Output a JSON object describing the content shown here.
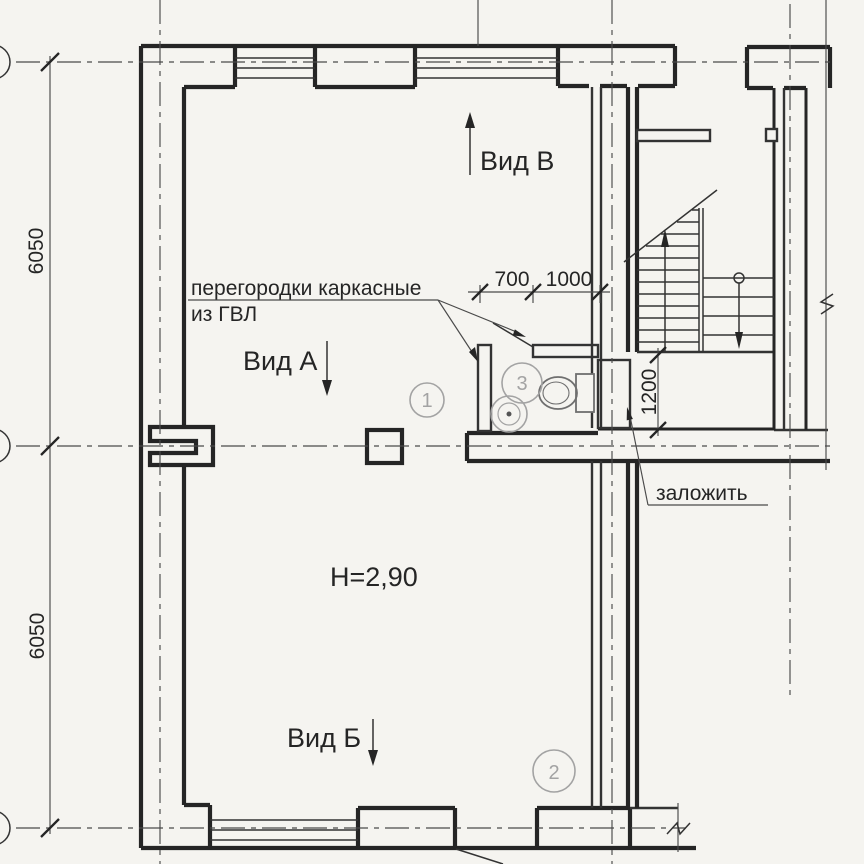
{
  "labels": {
    "partitions_note_line1": "перегородки каркасные",
    "partitions_note_line2": "из ГВЛ",
    "view_a": "Вид А",
    "view_v": "Вид В",
    "view_b": "Вид Б",
    "height_note": "Н=2,90",
    "block_up_note": "заложить"
  },
  "dimensions": {
    "axis_span_upper": "6050",
    "axis_span_lower": "6050",
    "door_width": "700",
    "partition_length": "1000",
    "blocked_opening_width": "1200"
  },
  "rooms": [
    {
      "number": "1"
    },
    {
      "number": "2"
    },
    {
      "number": "3"
    }
  ],
  "colors": {
    "paper": "#f5f4f0",
    "line_dark": "#252525",
    "line_light": "#a3a3a3"
  }
}
